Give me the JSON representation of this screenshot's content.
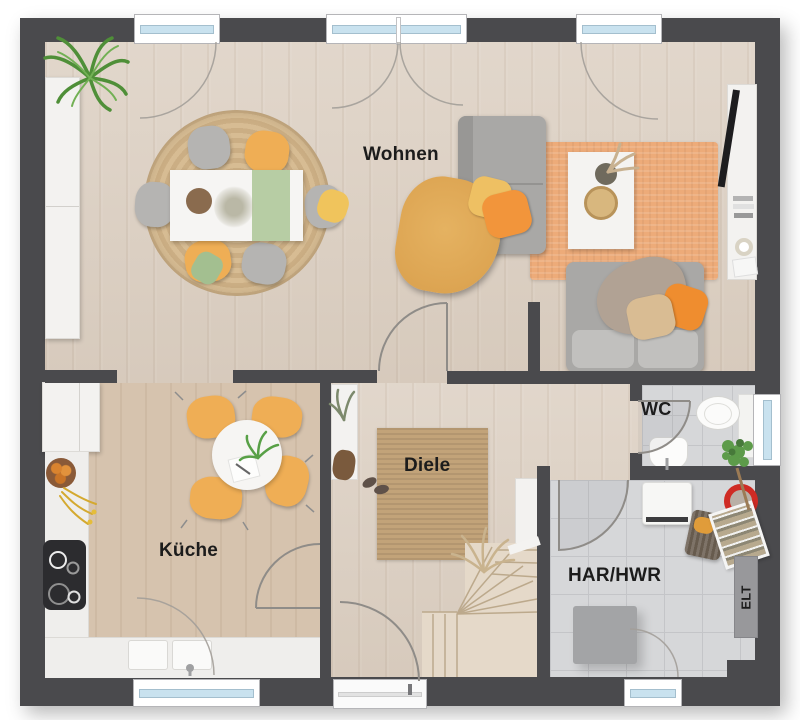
{
  "rooms": {
    "wohnen": {
      "label": "Wohnen"
    },
    "kueche": {
      "label": "Küche"
    },
    "diele": {
      "label": "Diele"
    },
    "wc": {
      "label": "WC"
    },
    "har_hwr": {
      "label": "HAR/HWR"
    },
    "elt": {
      "label": "ELT"
    }
  },
  "palette": {
    "wall": "#4a4a4d",
    "wood_floor": "#dbcec0",
    "kitchen_floor": "#d6c3ae",
    "tile_floor": "#d6d7d9",
    "stair_wood": "#e5d9c9",
    "living_rug": "#edab79",
    "jute_rug": "#c2a379",
    "sofa_gray": "#a9a8a6",
    "accent_orange": "#efae55",
    "accent_yellow": "#eec063",
    "plant_green": "#4f8f38",
    "window_glass": "#c9e2ef",
    "label_text": "#1c1c1c"
  }
}
